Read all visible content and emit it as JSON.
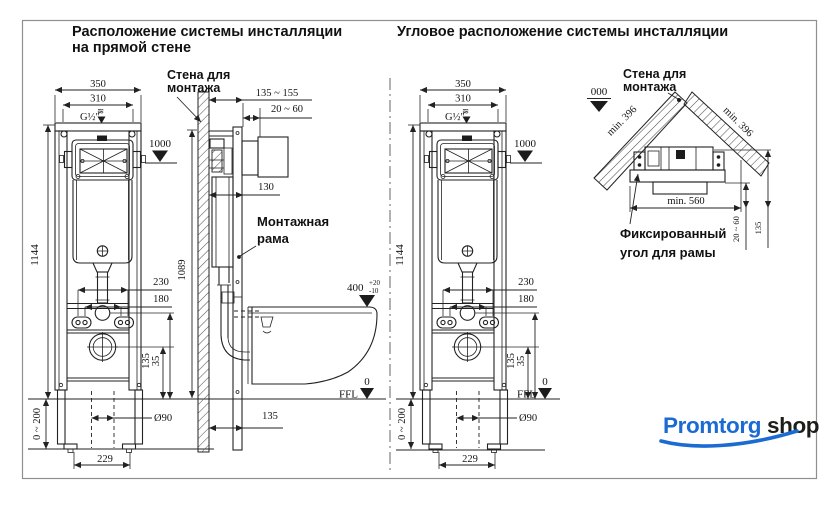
{
  "titles": {
    "left1": "Расположение  системы инсталляции",
    "left2": "на прямой  стене",
    "right": "Угловое расположение системы инсталляции"
  },
  "wall_label": {
    "l1": "Стена для",
    "l2": "монтажа"
  },
  "frame_label": {
    "l1": "Монтажная",
    "l2": "рама"
  },
  "fixed_label": {
    "l1": "Фиксированный",
    "l2": "угол для рамы"
  },
  "marks": {
    "ffl": "FFL",
    "zero": "0",
    "zero3": "000"
  },
  "dims": {
    "w350": "350",
    "w310": "310",
    "h1144": "1144",
    "h1089": "1089",
    "lvl1000": "1000",
    "depth_range": "135 ~ 155",
    "front_gap": "20 ~ 60",
    "d130": "130",
    "d230": "230",
    "d180": "180",
    "d135": "135",
    "d35": "35",
    "adj_range": "0 ~ 200",
    "feet229": "229",
    "drain_d": "Ø90",
    "seat400": "400",
    "tol_plus": "+20",
    "tol_minus": "-10",
    "wall_off135": "135",
    "min396": "min. 396",
    "min560": "min. 560",
    "corner_gap": "20 ~ 60",
    "corner_off": "135",
    "thread": "G½″",
    "supply": "≋"
  },
  "logo": {
    "part1": "Promtorg",
    "part2": "shop",
    "blue": "#1B6BD3",
    "dark": "#1D1D1B"
  }
}
